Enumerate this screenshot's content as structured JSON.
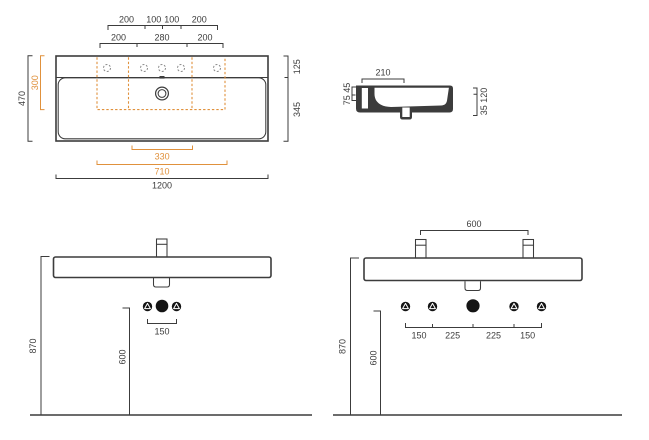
{
  "colors": {
    "accent": "#E0913C",
    "line": "#3C3C3C",
    "symbol": "#141414",
    "hole": "#8A8A8A"
  },
  "plan": {
    "row1": [
      "200",
      "100",
      "100",
      "200"
    ],
    "row2": [
      "200",
      "280",
      "200"
    ],
    "depth_total": "470",
    "tap_zone_depth": "300",
    "back_ledge": "125",
    "bowl_depth": "345",
    "siphon_width": "330",
    "tap_zone_width": "710",
    "width_total": "1200"
  },
  "side": {
    "ledge_depth": "210",
    "left_dims": "75 45",
    "right_dims": "35 120"
  },
  "front_single": {
    "rim_height": "870",
    "supply_height": "600",
    "connection_span": "150"
  },
  "front_double": {
    "tap_distance": "600",
    "rim_height": "870",
    "supply_height": "600",
    "spans": [
      "150",
      "225",
      "225",
      "150"
    ]
  }
}
